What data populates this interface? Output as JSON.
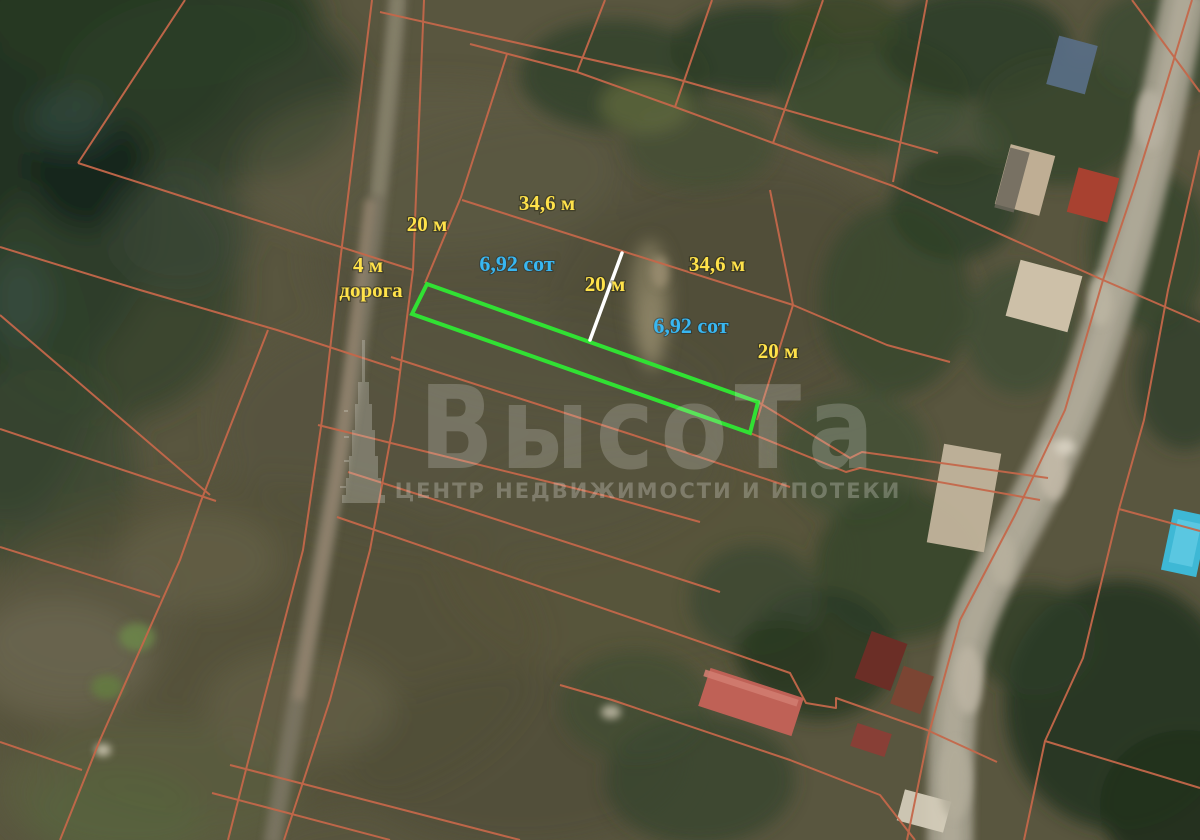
{
  "labels": [
    {
      "id": "width-top-left-parcel",
      "text": "34,6 м"
    },
    {
      "id": "side-top-left-parcel",
      "text": "20 м"
    },
    {
      "id": "access-road-width",
      "text": "4 м"
    },
    {
      "id": "access-road-name",
      "text": "дорога"
    },
    {
      "id": "area-left-parcel",
      "text": "6,92 сот"
    },
    {
      "id": "side-middle-divider",
      "text": "20 м"
    },
    {
      "id": "width-right-parcel",
      "text": "34,6 м"
    },
    {
      "id": "area-right-parcel",
      "text": "6,92 сот"
    },
    {
      "id": "side-right-parcel",
      "text": "20 м"
    }
  ],
  "watermark": {
    "brand": "ВысоТа",
    "subtitle": "ЦЕНТР НЕДВИЖИМОСТИ И ИПОТЕКИ"
  },
  "palette": {
    "dimension_text": "#ffe24a",
    "area_text": "#38b7f2",
    "cadastral_line": "#c5684a",
    "parcel_highlight": "#31e133",
    "divider_line": "#ffffff",
    "watermark_text": "#e8e8e2"
  }
}
